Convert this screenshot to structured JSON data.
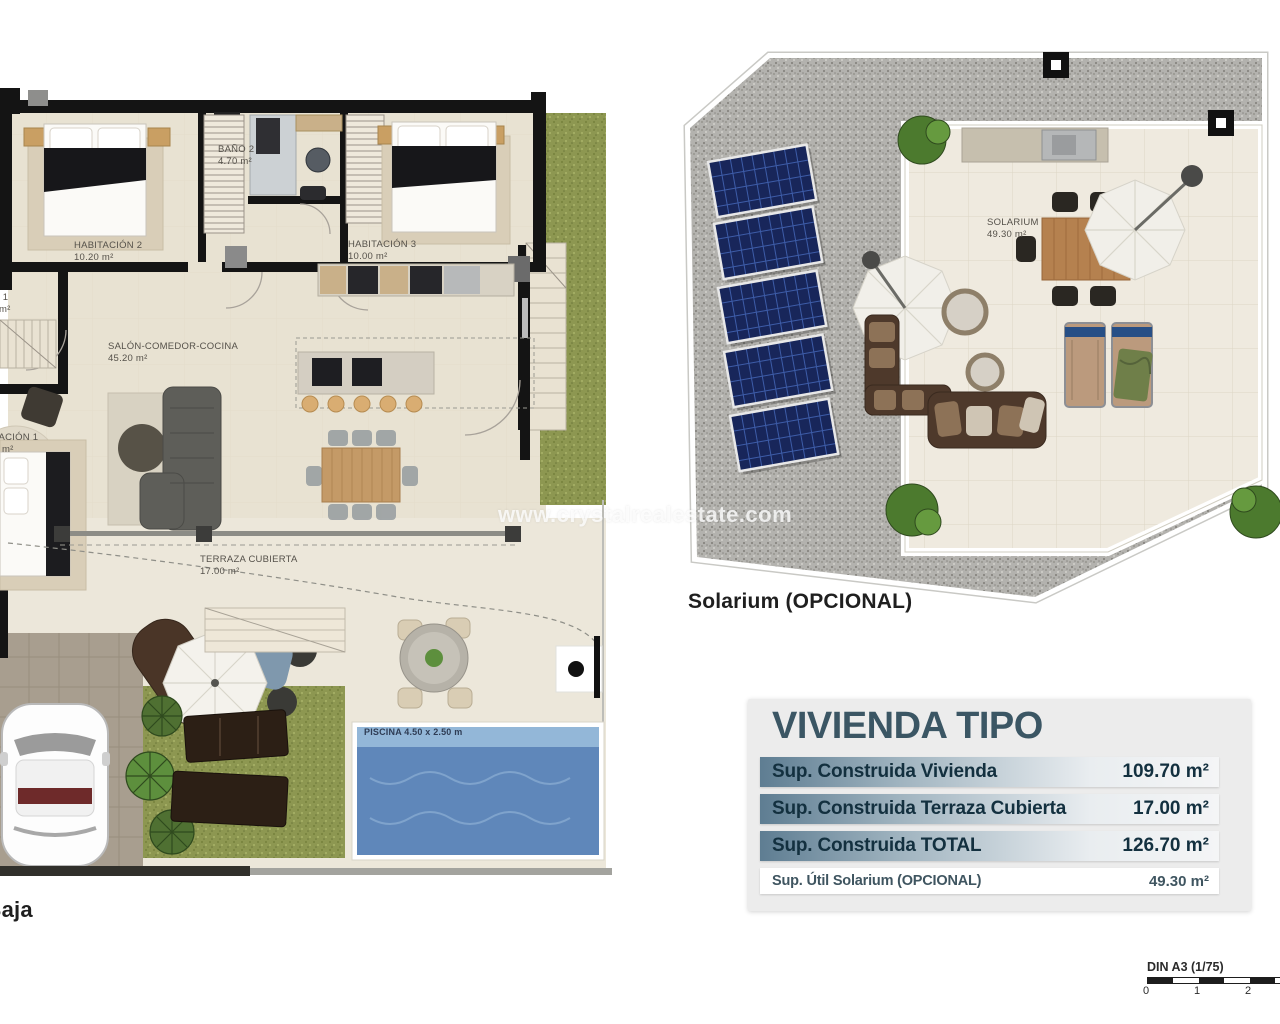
{
  "watermark": "www.crystalrealestate.com",
  "floor_plan": {
    "name": "Planta Baja",
    "rooms": {
      "habitacion2": {
        "label": "HABITACIÓN 2",
        "area": "10.20 m²"
      },
      "bano2": {
        "label": "BAÑO 2",
        "area": "4.70 m²"
      },
      "habitacion3": {
        "label": "HABITACIÓN 3",
        "area": "10.00 m²"
      },
      "salon": {
        "label": "SALÓN-COMEDOR-COCINA",
        "area": "45.20 m²"
      },
      "bano1": {
        "label": "BAÑO 1",
        "area": "m²"
      },
      "habitacion1": {
        "label": "HABITACIÓN 1",
        "area": "m²"
      },
      "terraza": {
        "label": "TERRAZA CUBIERTA",
        "area": "17.00 m²"
      }
    },
    "pool_label": "PISCINA 4.50 x 2.50 m"
  },
  "solarium_plan": {
    "caption": "Solarium (OPCIONAL)",
    "room": {
      "label": "SOLARIUM",
      "area": "49.30 m²"
    },
    "solar_panels_count": 5
  },
  "summary_table": {
    "title": "VIVIENDA TIPO",
    "rows": [
      {
        "label": "Sup. Construida Vivienda",
        "value": "109.70 m²"
      },
      {
        "label": "Sup. Construida Terraza Cubierta",
        "value": "17.00 m²"
      },
      {
        "label": "Sup. Construida TOTAL",
        "value": "126.70 m²"
      },
      {
        "label": "Sup. Útil Solarium (OPCIONAL)",
        "value": "49.30 m²"
      }
    ]
  },
  "scale_bar": {
    "label": "DIN A3 (1/75)",
    "ticks": [
      "0",
      "1",
      "2"
    ]
  },
  "colors": {
    "floor_beige": "#e8e2d2",
    "garden_beige": "#ece7da",
    "wall_black": "#141414",
    "grass_green": "#8d9751",
    "gravel_gray": "#b3b2ae",
    "pool_blue": "#5f87ba",
    "solar_panel_navy": "#18265a",
    "wood": "#c49a67",
    "sofa_gray": "#5e5e59",
    "table_title_teal": "#3b5664",
    "row_gradient_left": "#5e7d92",
    "row_text": "#13303f"
  }
}
